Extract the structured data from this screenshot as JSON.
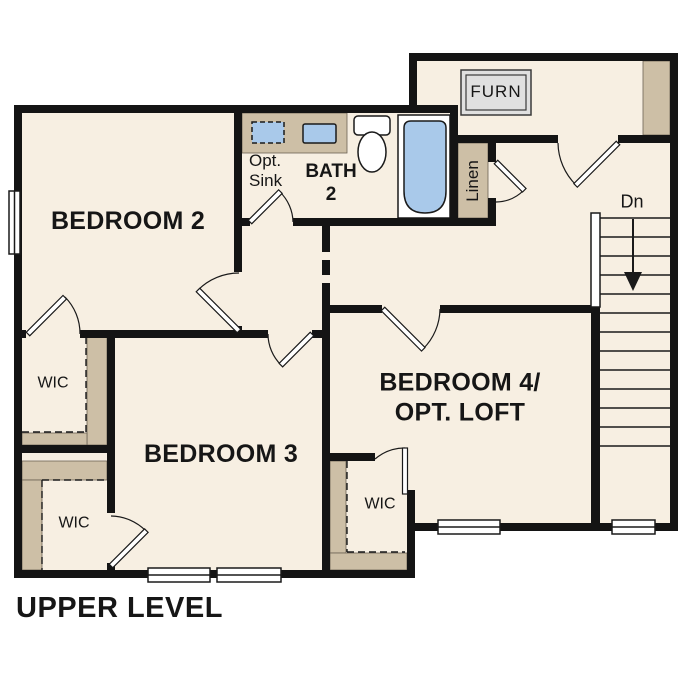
{
  "title": "UPPER LEVEL",
  "colors": {
    "floor": "#f7efe2",
    "wall": "#141414",
    "tan": "#cdbfa6",
    "blue": "#a9c9ea",
    "furn_gray": "#e0e0e0"
  },
  "rooms": {
    "bedroom2": {
      "label": "BEDROOM 2"
    },
    "bedroom3": {
      "label": "BEDROOM 3"
    },
    "bedroom4": {
      "label_line1": "BEDROOM 4/",
      "label_line2": "OPT. LOFT"
    },
    "bath2": {
      "label_line1": "BATH",
      "label_line2": "2"
    },
    "opt_sink": {
      "label_line1": "Opt.",
      "label_line2": "Sink"
    },
    "linen": {
      "label": "Linen"
    },
    "furnace_closet": {
      "label": "FURN"
    },
    "stairs": {
      "label": "Dn"
    },
    "wic_bedroom2": {
      "label": "WIC"
    },
    "wic_bedroom3": {
      "label": "WIC"
    },
    "wic_bedroom4": {
      "label": "WIC"
    }
  }
}
